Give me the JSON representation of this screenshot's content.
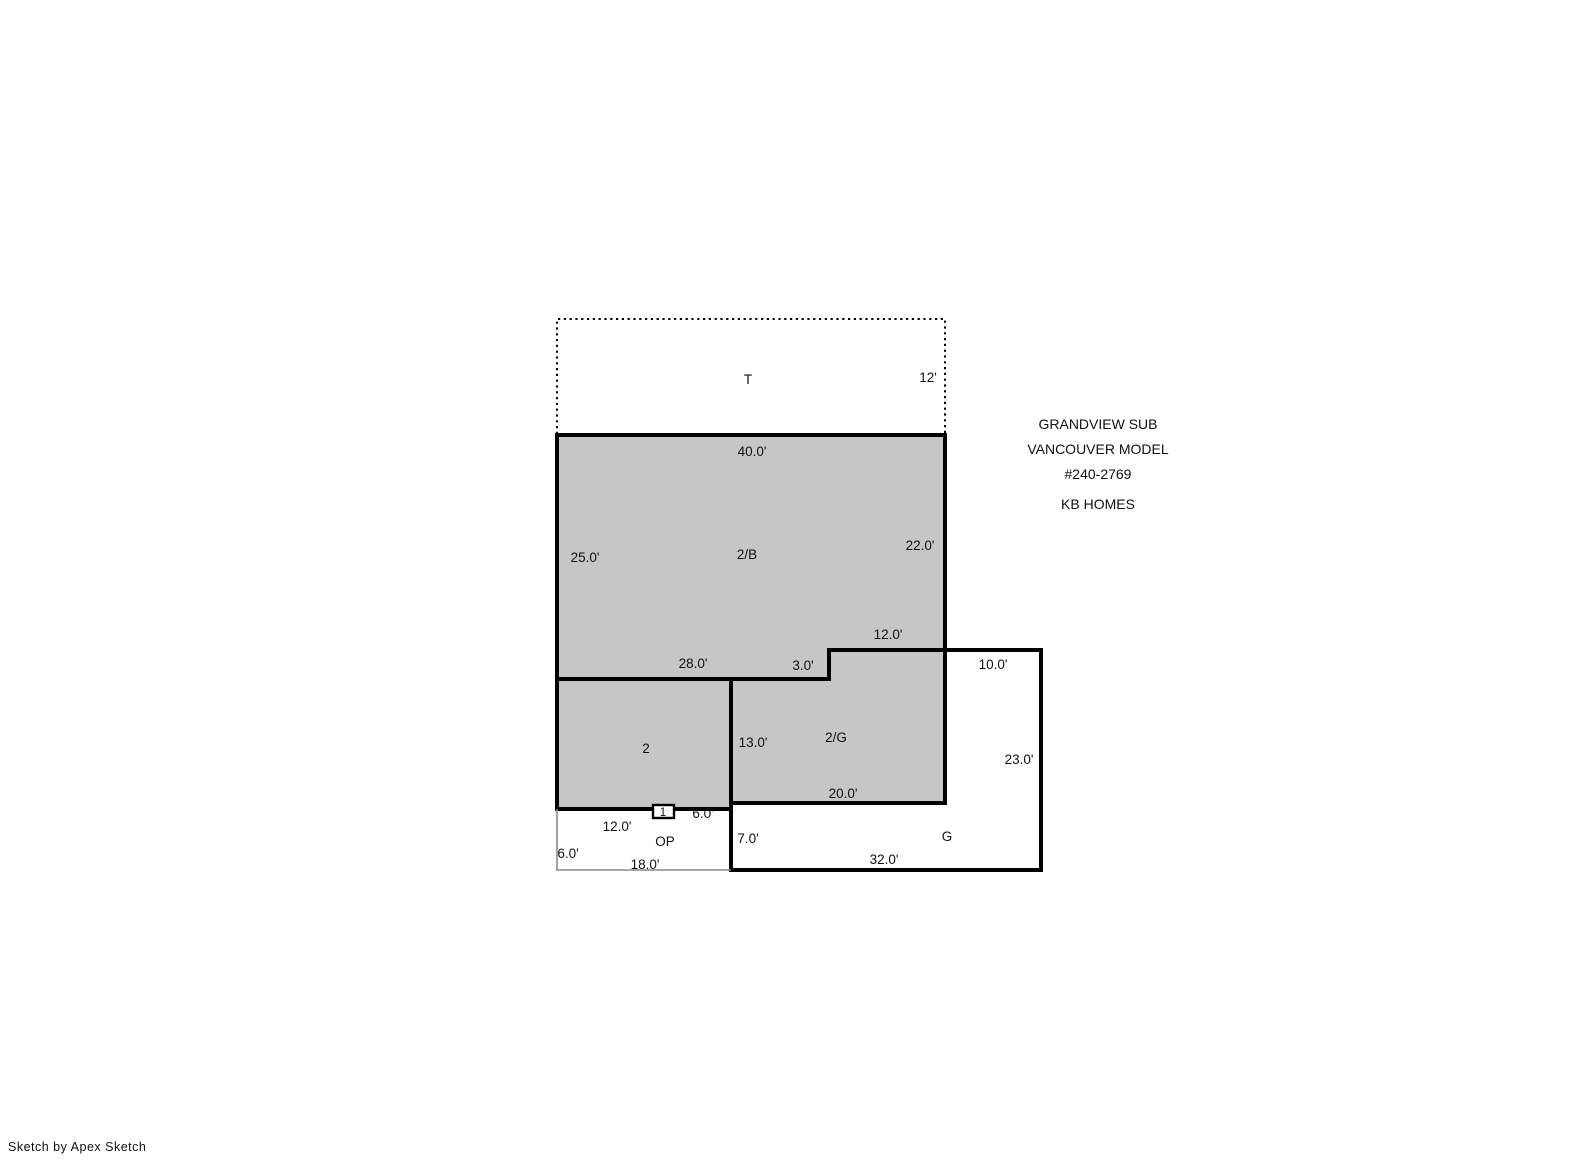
{
  "floorplan": {
    "attic_t": {
      "name": "T",
      "right": "12'"
    },
    "area_2b": {
      "name": "2/B",
      "top": "40.0'",
      "left": "25.0'",
      "right": "22.0'",
      "bottom": "28.0'",
      "notch_width": "12.0'",
      "notch_height": "3.0'"
    },
    "area_2": {
      "name": "2"
    },
    "area_2g": {
      "name": "2/G",
      "left": "13.0'",
      "bottom": "20.0'"
    },
    "garage": {
      "name": "G",
      "top": "10.0'",
      "right": "23.0'",
      "bottom": "32.0'",
      "left": "7.0'"
    },
    "porch": {
      "name": "OP",
      "top_left": "12.0'",
      "top_right": "6.0'",
      "left": "6.0'",
      "bottom": "18.0'"
    },
    "marker_1": {
      "name": "1"
    }
  },
  "title_block": {
    "line1": "GRANDVIEW SUB",
    "line2": "VANCOUVER MODEL",
    "line3": "#240-2769",
    "line4": "KB HOMES"
  },
  "footer": {
    "credit": "Sketch by Apex Sketch"
  },
  "colors": {
    "area_fill": "#c6c6c6",
    "garage_fill": "#ffffff",
    "wall": "#000000",
    "porch_border": "#8a8a8a"
  }
}
